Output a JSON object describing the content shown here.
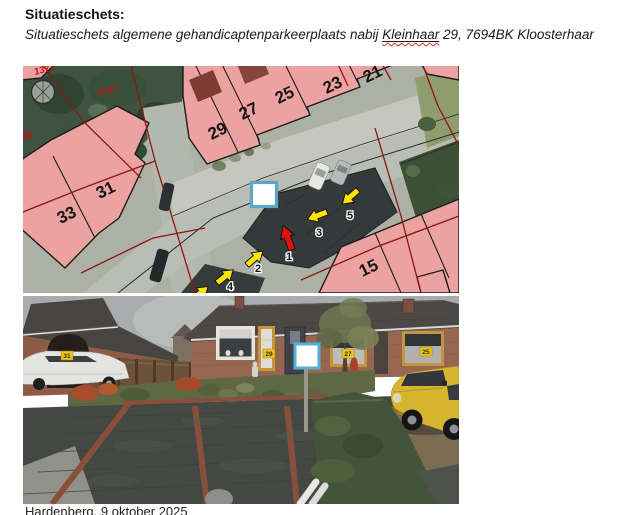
{
  "document": {
    "title": "Situatieschets:",
    "subtitle": {
      "prefix": "Situatieschets algemene gehandicaptenparkeerplaats nabij ",
      "street": "Kleinhaar",
      "suffix": " 29, 7694BK Kloosterhaar"
    },
    "footer": "Hardenberg, 9 oktober 2025"
  },
  "map": {
    "kind": "aerial-cadastral-map",
    "parcel_numbers": [
      "1371",
      "1747",
      "48"
    ],
    "house_numbers": [
      "29",
      "27",
      "25",
      "23",
      "21",
      "33",
      "31",
      "15"
    ],
    "arrow_labels": [
      "1",
      "2",
      "3",
      "4",
      "5"
    ],
    "marker": "white-square-highlight",
    "colors": {
      "building_fill": "#eda2a2",
      "boundary_red": "#8e1711",
      "arrow_yellow": "#ffe400",
      "arrow_red": "#e31010",
      "marker_border": "#5ba7c4"
    }
  },
  "photo": {
    "kind": "street-view-photo",
    "house_badges": [
      "31",
      "29",
      "27",
      "25"
    ],
    "marker": "white-square-highlight",
    "colors": {
      "badge_yellow": "#e9c61c",
      "marker_border": "#54b1d5",
      "car_yellow": "#d6b52f"
    }
  }
}
